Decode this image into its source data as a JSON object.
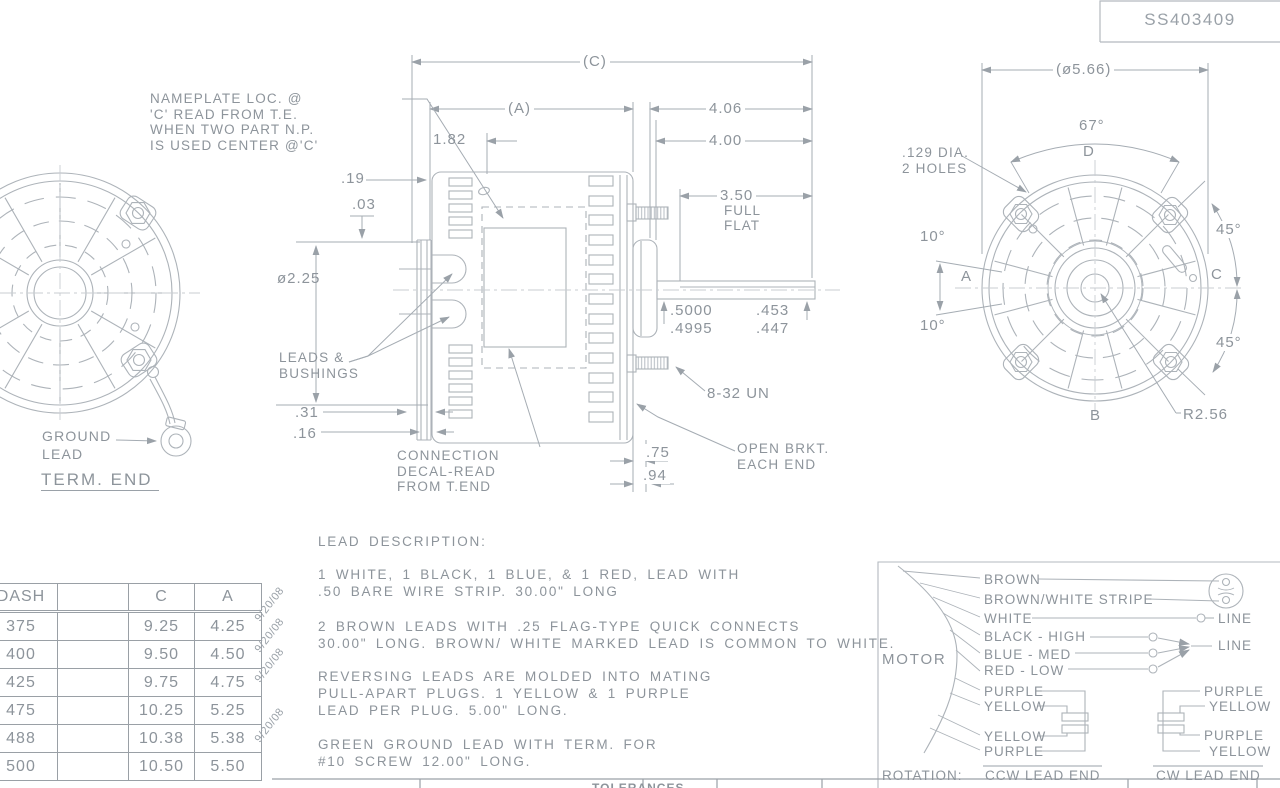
{
  "doc": {
    "part_number": "SS403409"
  },
  "left_view": {
    "ground_lead_label": "GROUND\nLEAD",
    "title": "TERM. END"
  },
  "side_view": {
    "nameplate_note": "NAMEPLATE LOC. @\n'C' READ FROM T.E.\nWHEN TWO PART N.P.\nIS USED CENTER @'C'",
    "dim_c": "(C)",
    "dim_a": "(A)",
    "dim_406": "4.06",
    "dim_400": "4.00",
    "dim_182": "1.82",
    "dim_19": ".19",
    "dim_03": ".03",
    "dim_dia225": "ø2.25",
    "dim_350": "3.50",
    "full_flat": "FULL\nFLAT",
    "leads_bushings": "LEADS &\nBUSHINGS",
    "shaft_dia": ".5000\n.4995",
    "flat_dim": ".453\n.447",
    "thread": "8-32 UN",
    "dim_31": ".31",
    "dim_16": ".16",
    "decal_note": "CONNECTION\nDECAL-READ\nFROM T.END",
    "dim_75": ".75",
    "dim_94": ".94",
    "open_brkt": "OPEN BRKT.\nEACH END"
  },
  "end_view": {
    "dim_dia566": "(ø5.66)",
    "angle_67": "67°",
    "label_d": "D",
    "holes_note": ".129 DIA.\n2 HOLES",
    "angle_10_top": "10°",
    "angle_10_bot": "10°",
    "label_a": "A",
    "label_b": "B",
    "label_c": "C",
    "angle_45_top": "45°",
    "angle_45_bot": "45°",
    "radius": "R2.56"
  },
  "dash_table": {
    "headers": [
      "DASH",
      "",
      "C",
      "A"
    ],
    "rows": [
      [
        "375",
        "9.25",
        "4.25"
      ],
      [
        "400",
        "9.50",
        "4.50"
      ],
      [
        "425",
        "9.75",
        "4.75"
      ],
      [
        "475",
        "10.25",
        "5.25"
      ],
      [
        "488",
        "10.38",
        "5.38"
      ],
      [
        "500",
        "10.50",
        "5.50"
      ]
    ],
    "rev_date": "9/20/08"
  },
  "lead_description": {
    "title": "LEAD DESCRIPTION:",
    "paragraphs": [
      "1 WHITE, 1 BLACK, 1 BLUE, & 1 RED, LEAD WITH\n.50 BARE WIRE STRIP. 30.00\" LONG",
      "2 BROWN LEADS WITH .25 FLAG-TYPE QUICK CONNECTS\n30.00\" LONG. BROWN/ WHITE MARKED LEAD IS COMMON TO WHITE.",
      "REVERSING LEADS ARE MOLDED INTO MATING\nPULL-APART PLUGS. 1 YELLOW & 1 PURPLE\nLEAD PER PLUG. 5.00\" LONG.",
      "GREEN GROUND LEAD WITH TERM. FOR\n#10 SCREW 12.00\" LONG."
    ]
  },
  "wiring": {
    "motor_label": "MOTOR",
    "leads": [
      "BROWN",
      "BROWN/WHITE STRIPE",
      "WHITE",
      "BLACK - HIGH",
      "BLUE - MED",
      "RED - LOW",
      "PURPLE",
      "YELLOW",
      "YELLOW",
      "PURPLE"
    ],
    "line_label_1": "LINE",
    "line_label_2": "LINE",
    "right_leads": [
      "PURPLE",
      "YELLOW",
      "PURPLE",
      "YELLOW"
    ],
    "rotation_label": "ROTATION:",
    "ccw": "CCW LEAD END",
    "cw": "CW LEAD END"
  },
  "title_block": {
    "tolerances": "TOLERANCES"
  },
  "colors": {
    "line": "#adb3b9",
    "ink": "#8d949b"
  }
}
